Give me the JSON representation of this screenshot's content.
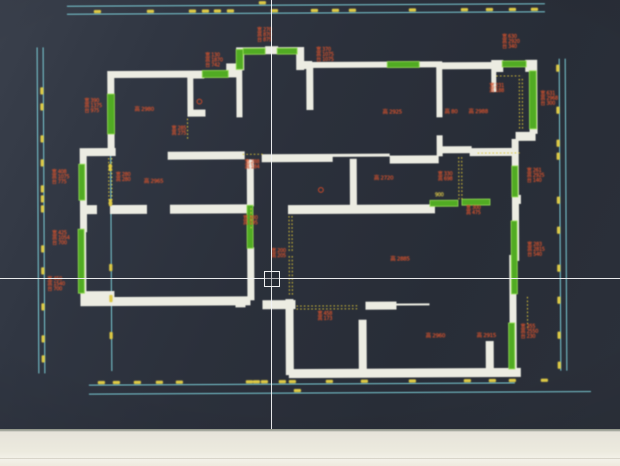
{
  "theme": {
    "screen_background": "#2b303b",
    "wall_white": "#ecece2",
    "window_green": "#54aa28",
    "dimension_cyan": "#82d4de",
    "tick_yellow": "#dcc94b",
    "label_red": "#cf5130",
    "bezel_cream": "#eceade"
  },
  "cursor": {
    "crosshair_x": 271,
    "crosshair_y": 278,
    "pickbox_size": 14
  },
  "notes": {
    "window_notes": [
      {
        "x": 258,
        "y": 28,
        "lines": [
          "宽 270",
          "高 870",
          "台 875"
        ]
      },
      {
        "x": 206,
        "y": 53,
        "lines": [
          "宽 130",
          "高 1870",
          "台 742"
        ]
      },
      {
        "x": 317,
        "y": 48,
        "lines": [
          "宽 370",
          "高 1075",
          "台 1075"
        ]
      },
      {
        "x": 503,
        "y": 36,
        "lines": [
          "宽 630",
          "高 2920",
          "台 340"
        ]
      },
      {
        "x": 85,
        "y": 98,
        "lines": [
          "宽 390",
          "高 1375",
          "台 975"
        ]
      },
      {
        "x": 541,
        "y": 93,
        "lines": [
          "宽 631",
          "高 2968",
          "台 300"
        ]
      },
      {
        "x": 52,
        "y": 169,
        "lines": [
          "宽 408",
          "高 1075",
          "台 775"
        ]
      },
      {
        "x": 527,
        "y": 170,
        "lines": [
          "宽 261",
          "高 2925",
          "台 140"
        ]
      },
      {
        "x": 52,
        "y": 230,
        "lines": [
          "宽 425",
          "高 1054",
          "台 700"
        ]
      },
      {
        "x": 47,
        "y": 276,
        "lines": [
          "宽 450",
          "高 1540",
          "台 700"
        ]
      },
      {
        "x": 527,
        "y": 244,
        "lines": [
          "宽 283",
          "高 2815",
          "台 540"
        ]
      },
      {
        "x": 520,
        "y": 326,
        "lines": [
          "宽 355",
          "高 2550",
          "台 230"
        ]
      }
    ],
    "beam_notes": [
      {
        "x": 172,
        "y": 126,
        "lines": [
          "宽 285",
          "高 275"
        ]
      },
      {
        "x": 116,
        "y": 172,
        "lines": [
          "宽 280",
          "高 280"
        ]
      },
      {
        "x": 245,
        "y": 160,
        "lines": [
          "宽 288",
          "高 184"
        ]
      },
      {
        "x": 490,
        "y": 85,
        "lines": [
          "宽 231",
          "高 188"
        ]
      },
      {
        "x": 466,
        "y": 207,
        "lines": [
          "宽 300",
          "高 475"
        ]
      },
      {
        "x": 317,
        "y": 312,
        "lines": [
          "宽 458",
          "高 173"
        ]
      },
      {
        "x": 243,
        "y": 216,
        "lines": [
          "宽 300",
          "高 195"
        ]
      },
      {
        "x": 271,
        "y": 249,
        "lines": [
          "宽 200",
          "高 205"
        ]
      },
      {
        "x": 438,
        "y": 173,
        "lines": [
          "宽 330",
          "高 698"
        ]
      }
    ],
    "room_notes": [
      {
        "x": 135,
        "y": 107,
        "text": "高 2980"
      },
      {
        "x": 383,
        "y": 111,
        "text": "高 2925"
      },
      {
        "x": 445,
        "y": 111,
        "text": "高 80"
      },
      {
        "x": 469,
        "y": 111,
        "text": "高 2988"
      },
      {
        "x": 144,
        "y": 179,
        "text": "高 2965"
      },
      {
        "x": 374,
        "y": 177,
        "text": "高 2720"
      },
      {
        "x": 390,
        "y": 258,
        "text": "高 2885"
      },
      {
        "x": 425,
        "y": 335,
        "text": "高 2960"
      },
      {
        "x": 476,
        "y": 335,
        "text": "高 2915"
      }
    ],
    "wall_note": {
      "x": 435,
      "y": 194,
      "text": "900"
    }
  },
  "dimensions": {
    "top": {
      "line1_y": 5,
      "line2_y": 13,
      "x_start": 68,
      "x_end": 546,
      "ticks": [
        95,
        148,
        190,
        203,
        215,
        228,
        272,
        312,
        333,
        350,
        410,
        462,
        487,
        510,
        532
      ],
      "total_tick_x": 260
    },
    "bottom": {
      "line1_y": 384,
      "line2_y": 393,
      "x_start": 88,
      "x_end1": 514,
      "x_end2": 590,
      "ticks": [
        97,
        112,
        133,
        155,
        175,
        245,
        252,
        260,
        278,
        288,
        325,
        360,
        408,
        463,
        488,
        508,
        540
      ],
      "lower_ticks": [
        293
      ]
    },
    "left": {
      "line1_x": 38,
      "line2_x": 44,
      "y_start": 46,
      "y_end": 372,
      "ticks": [
        88,
        104,
        136,
        160,
        186,
        196,
        206,
        246,
        268,
        304,
        336,
        356
      ]
    },
    "inner_left": {
      "line_x": 111,
      "y_start": 150,
      "y_end": 370,
      "ticks": [
        165,
        200,
        265,
        296,
        333
      ]
    },
    "right": {
      "line1_x": 560,
      "line2_x": 566,
      "y_start": 60,
      "y_end": 372,
      "ticks": [
        68,
        110,
        143,
        156,
        200,
        230,
        268,
        300,
        335,
        365
      ]
    }
  }
}
